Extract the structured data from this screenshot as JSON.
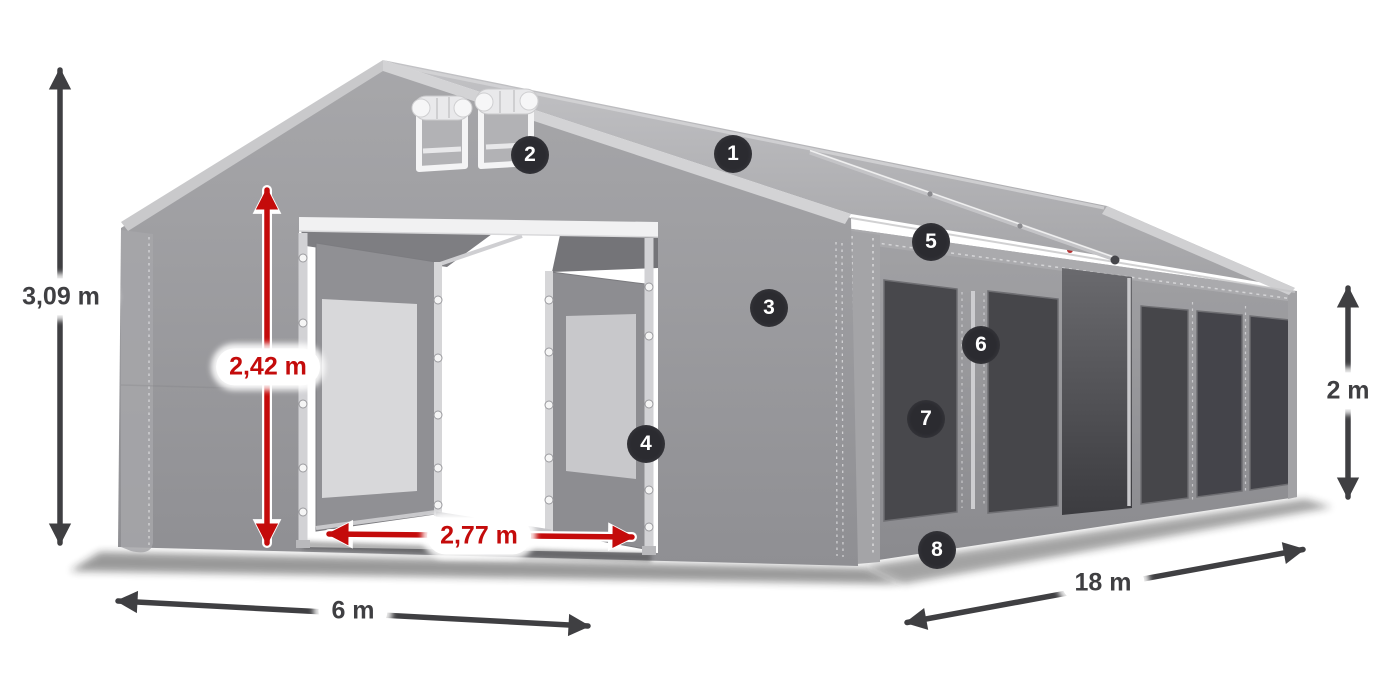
{
  "dimensions": {
    "total_height": "3,09 m",
    "entrance_height": "2,42 m",
    "entrance_width": "2,77 m",
    "width": "6 m",
    "length": "18 m",
    "side_height": "2 m"
  },
  "callouts": [
    "1",
    "2",
    "3",
    "4",
    "5",
    "6",
    "7",
    "8"
  ],
  "colors": {
    "accent_red": "#c40b0b",
    "arrow_dark": "#3f3f42",
    "badge_background": "#2b2b30",
    "badge_text": "#ffffff",
    "tarp_gray": "#9b9b9f",
    "roof_gray": "#b5b5b8",
    "window_dark": "#48484c",
    "label_background": "#ffffff"
  }
}
